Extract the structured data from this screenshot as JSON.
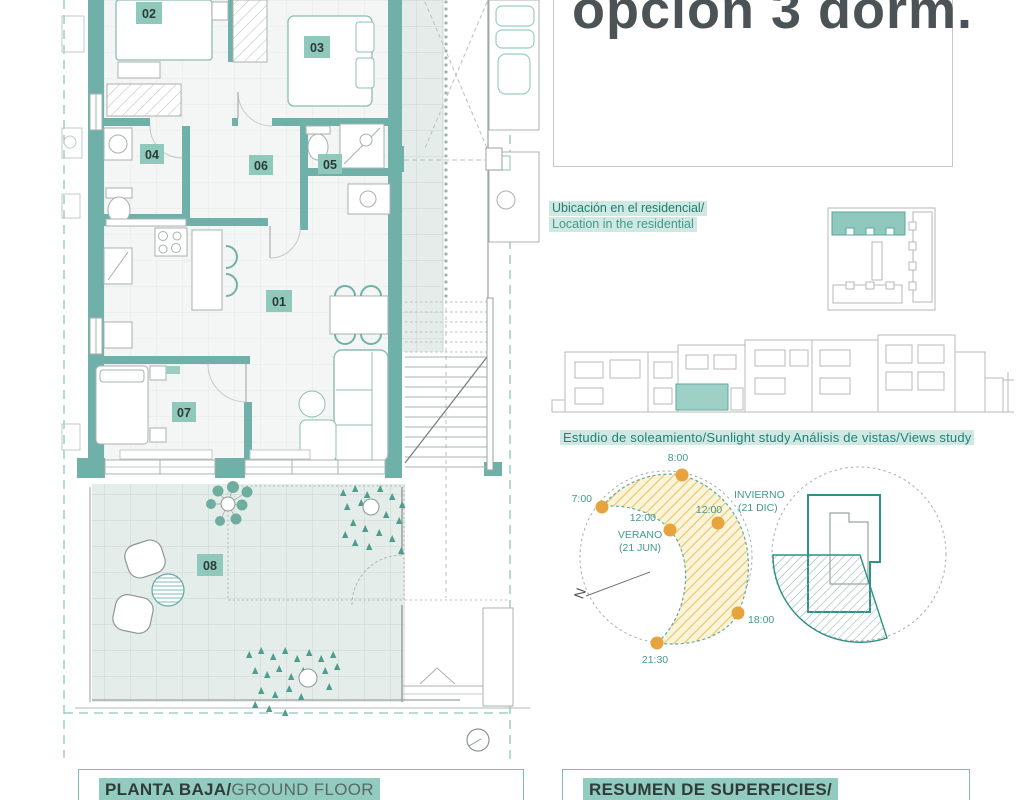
{
  "header": {
    "title": "opción 3 dorm."
  },
  "location": {
    "line_es": "Ubicación en el residencial/",
    "line_en": "Location in the residential"
  },
  "studies": {
    "sunlight_heading": "Estudio de soleamiento/Sunlight study",
    "views_heading": "Análisis de vistas/Views study",
    "sun": {
      "t_8": "8:00",
      "t_7": "7:00",
      "noon_summer": "12:00",
      "summer_name": "VERANO",
      "summer_date": "(21 JUN)",
      "noon_winter": "12:00",
      "winter_name": "INVIERNO",
      "winter_date": "(21 DIC)",
      "t_18": "18:00",
      "t_2130": "21:30",
      "north": "N"
    }
  },
  "floorplan": {
    "rooms": [
      {
        "id": "01"
      },
      {
        "id": "02"
      },
      {
        "id": "03"
      },
      {
        "id": "04"
      },
      {
        "id": "05"
      },
      {
        "id": "06"
      },
      {
        "id": "07"
      },
      {
        "id": "08"
      }
    ]
  },
  "footer": {
    "left_es": "PLANTA BAJA/",
    "left_en": "GROUND FLOOR",
    "right_title": "RESUMEN DE SUPERFICIES/"
  },
  "colors": {
    "teal_wall": "#6fb1a9",
    "teal_text": "#1f7e76",
    "chip_bg": "#8fc9bc",
    "highlight": "#cfe9e2",
    "footer_highlight": "#92cbbf",
    "sun_orange": "#e9a33e",
    "sun_hatch": "#e8c468",
    "views_teal": "#2f9187"
  }
}
